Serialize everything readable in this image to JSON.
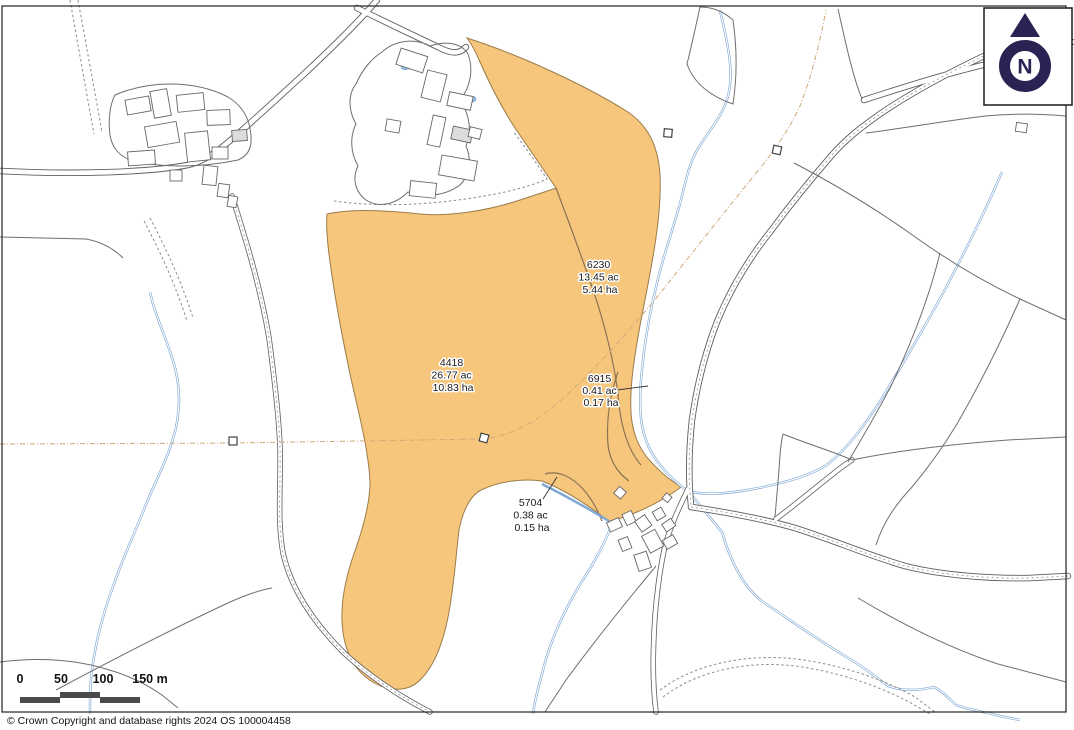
{
  "map": {
    "highlight_color": "#f6c67c",
    "parcels": [
      {
        "id": "6230",
        "acres": "13.45 ac",
        "hectares": "5.44 ha"
      },
      {
        "id": "4418",
        "acres": "26.77 ac",
        "hectares": "10.83 ha"
      },
      {
        "id": "6915",
        "acres": "0.41 ac",
        "hectares": "0.17 ha"
      },
      {
        "id": "5704",
        "acres": "0.38 ac",
        "hectares": "0.15 ha"
      }
    ]
  },
  "north_arrow": {
    "label": "N",
    "color": "#2b2153"
  },
  "scale_bar": {
    "labels": [
      "0",
      "50",
      "100",
      "150 m"
    ]
  },
  "footer": {
    "copyright": "© Crown Copyright and database rights 2024 OS 100004458"
  }
}
